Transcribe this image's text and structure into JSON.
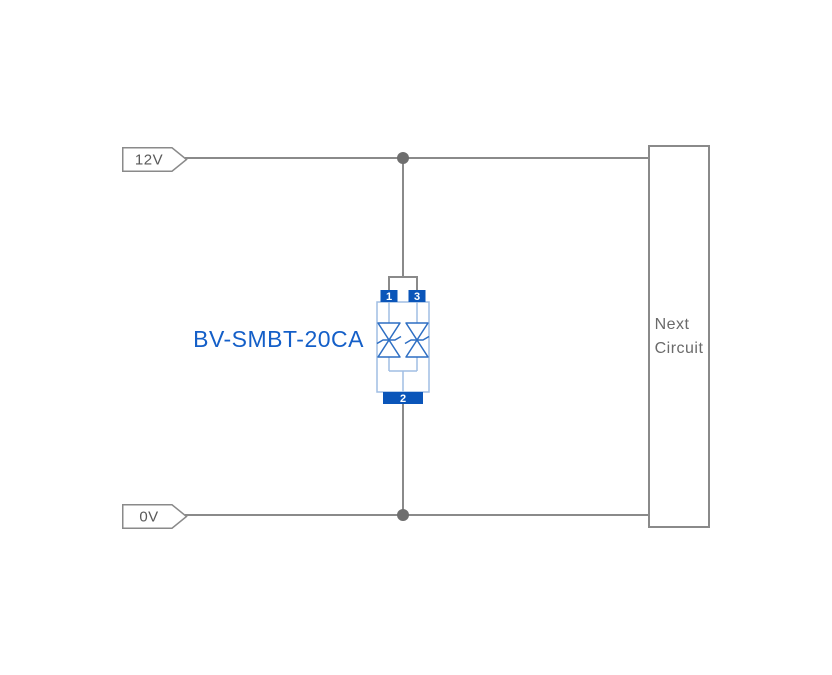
{
  "diagram": {
    "net_labels": {
      "top": "12V",
      "bottom": "0V"
    },
    "component": {
      "label": "BV-SMBT-20CA",
      "pin_top_left": "1",
      "pin_top_right": "3",
      "pin_bottom": "2"
    },
    "next_circuit": {
      "line1": "Next",
      "line2": "Circuit"
    },
    "colors": {
      "background": "#ffffff",
      "wire": "#8a8a8a",
      "junction_dot": "#6e6e6e",
      "net_label_outline": "#8a8a8a",
      "net_label_text": "#595959",
      "component_body_outline": "#a0bee4",
      "diode_symbol": "#2d6ec3",
      "pad_fill": "#0a55b9",
      "pad_text": "#ffffff",
      "component_label_text": "#145fc8",
      "next_circuit_border": "#8a8a8a",
      "next_circuit_text": "#6a6a6a"
    }
  }
}
